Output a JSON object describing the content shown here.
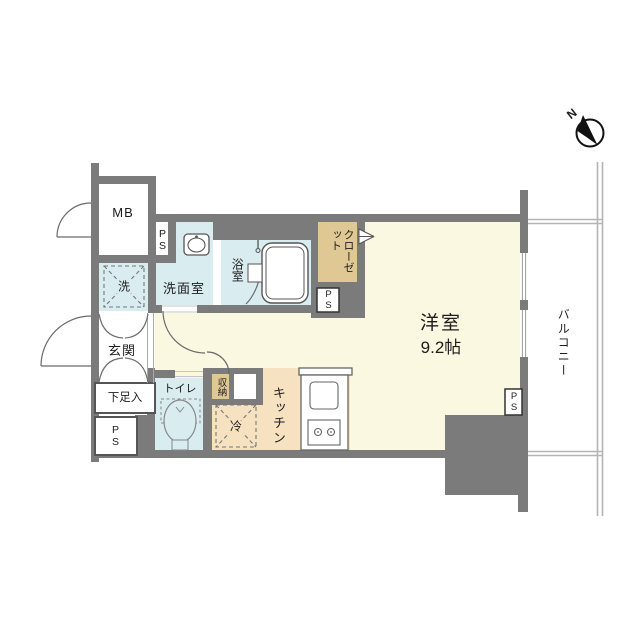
{
  "colors": {
    "wall": "#7b7b7b",
    "floor": "#fbf8e1",
    "wet": "#d9edf1",
    "closetc": "#dfc893",
    "kitchen": "#f6e2c1",
    "line": "#5f5f5f",
    "rail": "#b4b4b4"
  },
  "labels": {
    "mb": "MB",
    "ps": "PS",
    "washroom": "洗面室",
    "bathroom": "浴室",
    "closet": "クローゼット",
    "washer": "洗",
    "entrance": "玄関",
    "shoe_cabinet": "下足入",
    "toilet": "トイレ",
    "storage": "収納",
    "fridge": "冷",
    "kitchen": "キッチン",
    "north": "N"
  },
  "main_room": {
    "name": "洋室",
    "size": "9.2帖"
  },
  "balcony": {
    "label": "バルコニー"
  }
}
